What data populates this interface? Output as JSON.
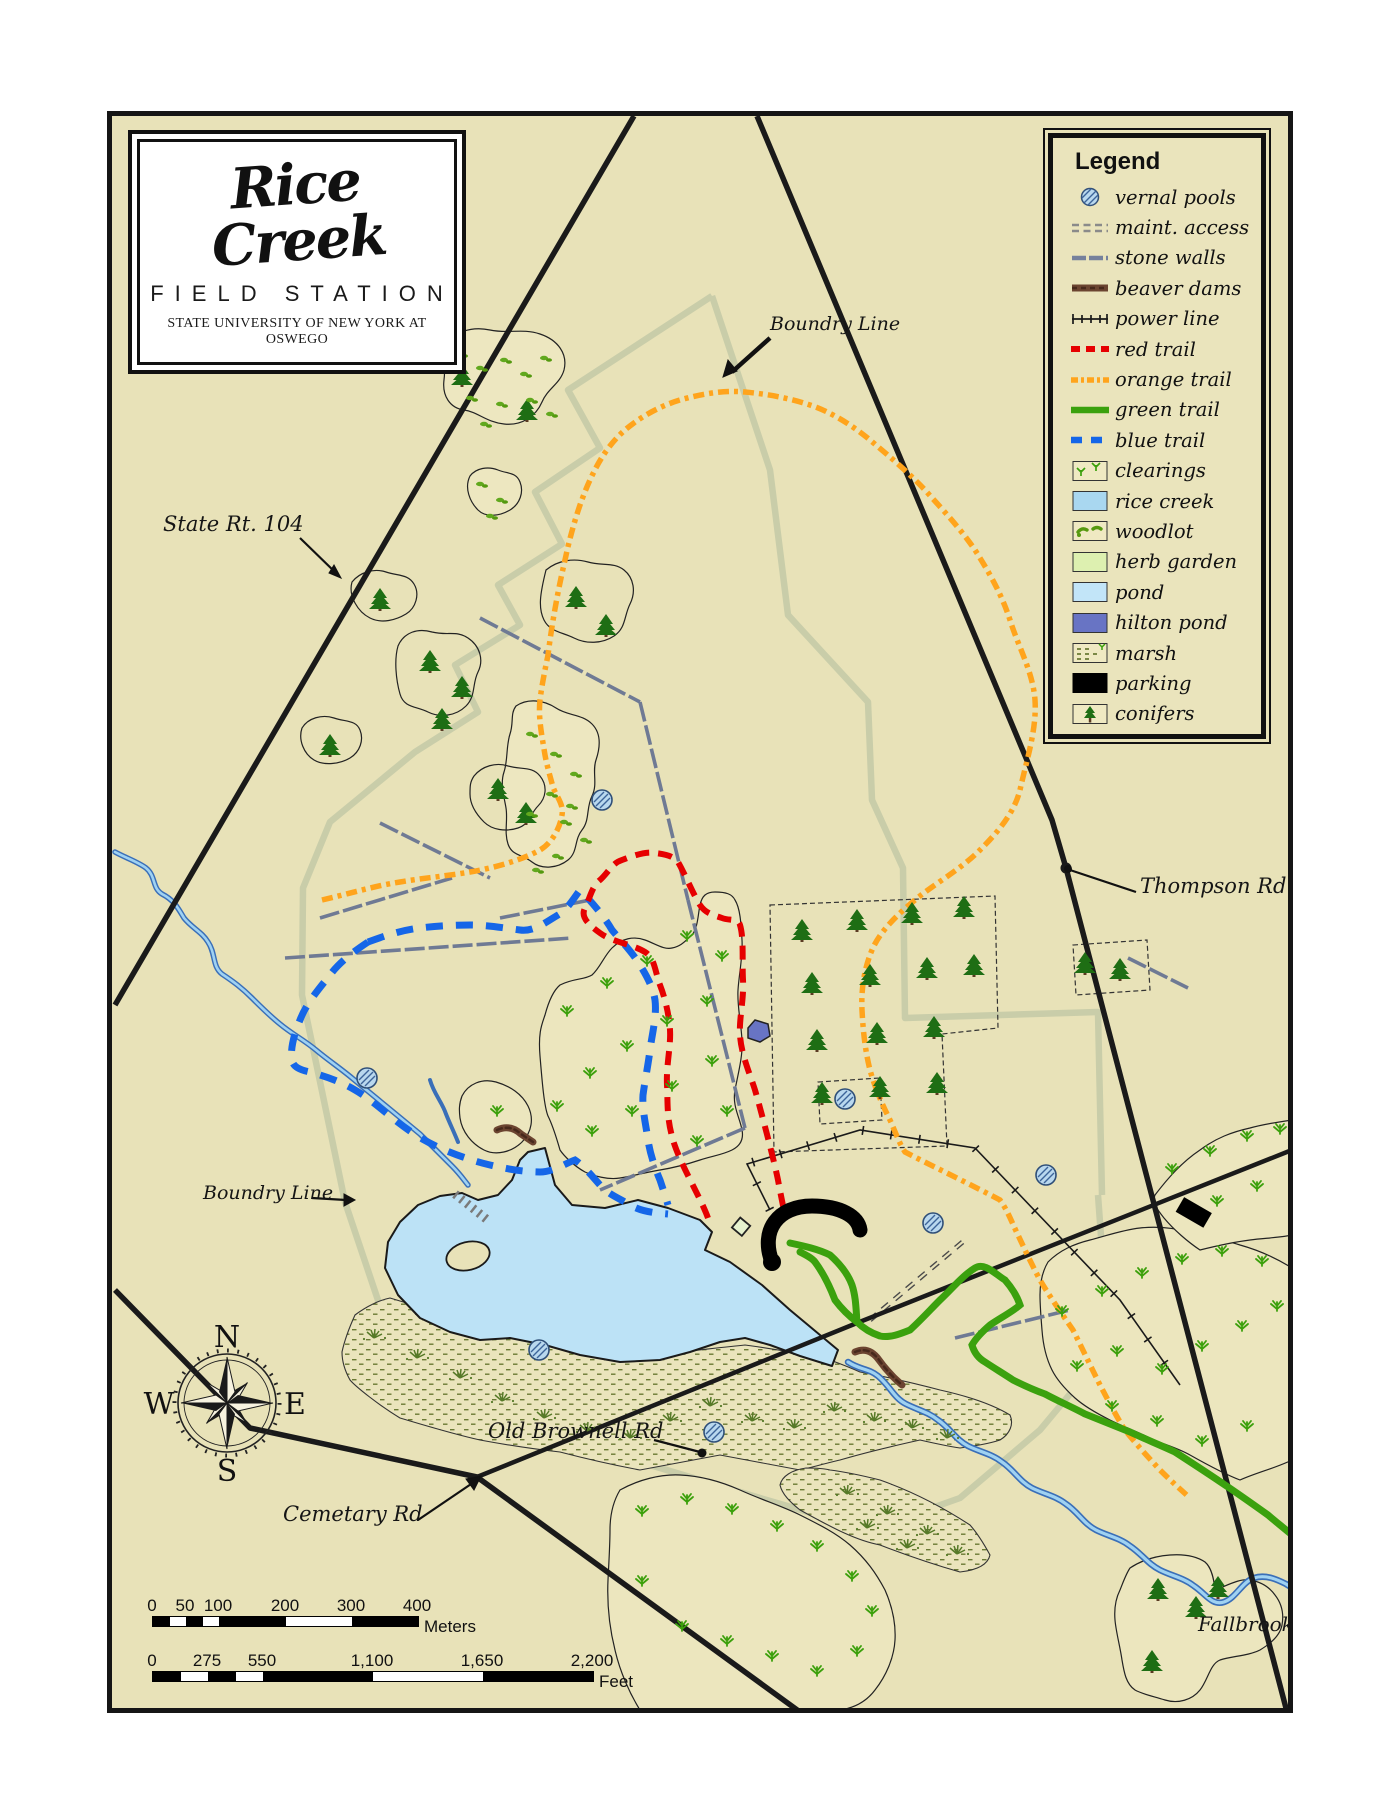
{
  "logo": {
    "title": "Rice Creek",
    "subtitle": "FIELD STATION",
    "institution": "STATE UNIVERSITY OF NEW YORK AT OSWEGO"
  },
  "legend": {
    "title": "Legend",
    "items": [
      {
        "label": "vernal pools"
      },
      {
        "label": "maint. access"
      },
      {
        "label": "stone walls"
      },
      {
        "label": "beaver dams"
      },
      {
        "label": "power line"
      },
      {
        "label": "red trail"
      },
      {
        "label": "orange trail"
      },
      {
        "label": "green trail"
      },
      {
        "label": "blue trail"
      },
      {
        "label": "clearings"
      },
      {
        "label": "rice creek"
      },
      {
        "label": "woodlot"
      },
      {
        "label": "herb garden"
      },
      {
        "label": "pond"
      },
      {
        "label": "hilton pond"
      },
      {
        "label": "marsh"
      },
      {
        "label": "parking"
      },
      {
        "label": "conifers"
      }
    ]
  },
  "labels": {
    "state_rt": "State Rt. 104",
    "boundry_top": "Boundry Line",
    "thompson": "Thompson Rd",
    "boundry_west": "Boundry Line",
    "old_brownell": "Old Brownell Rd",
    "cemetary": "Cemetary Rd",
    "fallbrook": "Fallbrook"
  },
  "compass": {
    "n": "N",
    "e": "E",
    "s": "S",
    "w": "W"
  },
  "scale_bars": {
    "meters": {
      "ticks": [
        "0",
        "50",
        "100",
        "200",
        "300",
        "400"
      ],
      "unit": "Meters"
    },
    "feet": {
      "ticks": [
        "0",
        "275",
        "550",
        "1,100",
        "1,650",
        "2,200"
      ],
      "unit": "Feet"
    }
  },
  "colors": {
    "map_background": "#E8E2B8",
    "boundary_line": "#C9CDA9",
    "road": "#1A1A1A",
    "stone_wall": "#76819C",
    "beaver_dam": "#6B4430",
    "red_trail": "#E60000",
    "orange_trail": "#FFA41C",
    "green_trail": "#3BA10E",
    "blue_trail": "#1566E8",
    "rice_creek": "#A9D7F0",
    "pond": "#BCE2F6",
    "hilton_pond": "#6874C4",
    "herb_garden": "#DDF0B0",
    "parking": "#000000",
    "conifer_green": "#1E6E14",
    "clearing_green": "#3CA00C"
  }
}
